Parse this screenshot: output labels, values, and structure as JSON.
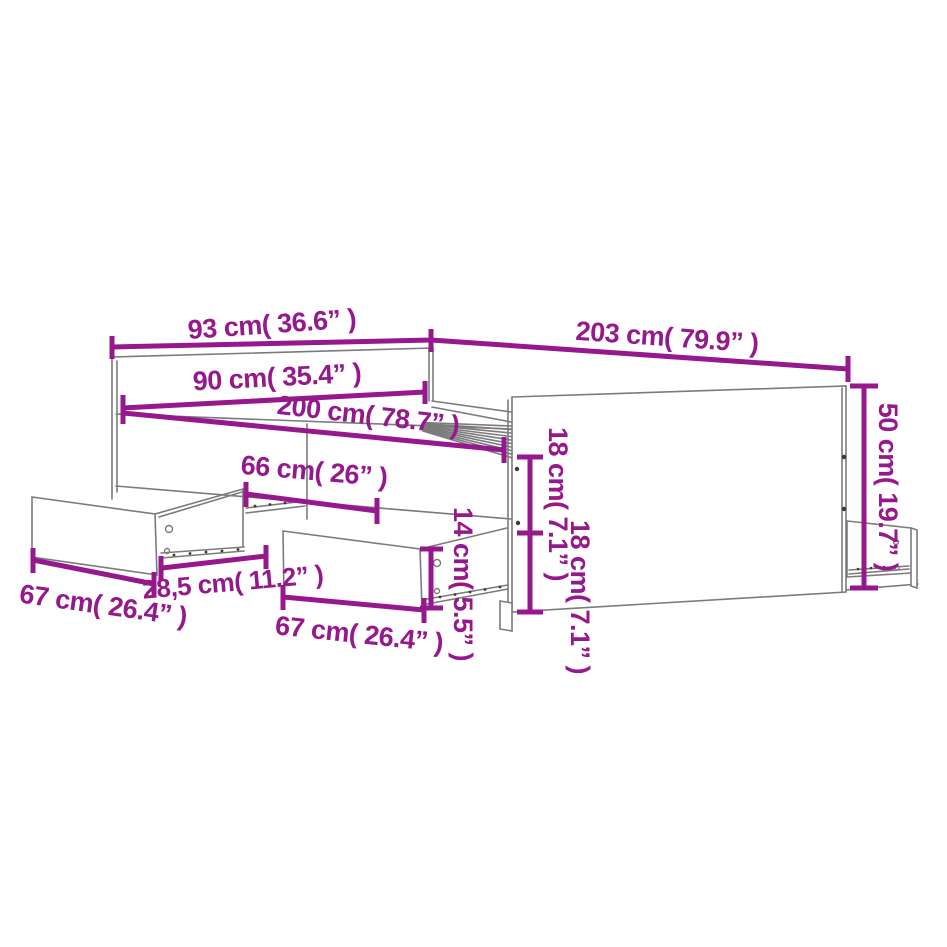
{
  "diagram": {
    "title": "bed-frame-with-drawers-dimension-diagram",
    "colors": {
      "dimension_accent": "#96188d",
      "outline_gray": "#7b7b7b",
      "background": "#ffffff"
    },
    "labels": {
      "headboard_width": "93 cm( 36.6”  )",
      "outer_length": "203 cm( 79.9”  )",
      "inner_width": "90 cm( 35.4”  )",
      "inner_length": "200 cm( 78.7”  )",
      "drawer_bay_width": "66 cm( 26”  )",
      "upper_side_height": "18 cm( 7.1”  )",
      "lower_side_height": "18 cm( 7.1”  )",
      "drawer_front_height": "14 cm( 5.5”  )",
      "footboard_height": "50 cm( 19.7”  )",
      "slide_length": "28,5 cm( 11.2”  )",
      "left_drawer_width": "67 cm( 26.4”  )",
      "middle_drawer_width": "67 cm( 26.4”  )"
    }
  }
}
